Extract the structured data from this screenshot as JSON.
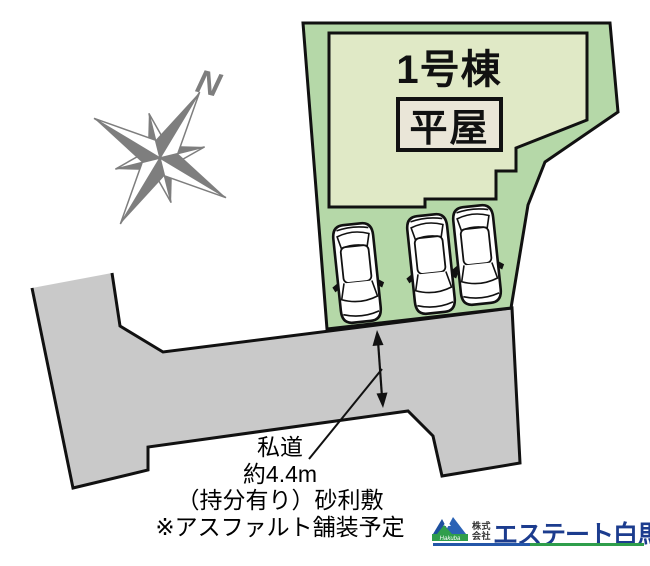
{
  "site_plan": {
    "building_label": "1号棟",
    "building_type_label": "平屋",
    "compass_label": "N",
    "road_note": {
      "line1": "私道",
      "line2": "約4.4m",
      "line3": "（持分有り）砂利敷",
      "line4": "※アスファルト舗装予定"
    },
    "car_count": 3
  },
  "colors": {
    "plot_green": "#b5d8a8",
    "building_fill": "#e0e9c6",
    "type_badge_fill": "#eae6d8",
    "road_gray": "#c9c9c9",
    "outline_black": "#111111",
    "compass_gray": "#7e7e7e"
  },
  "logo": {
    "prefix_line1": "株式",
    "prefix_line2": "会社",
    "company_name": "エステート白馬",
    "mountain_script": "Hakuba",
    "navy": "#1c3c8e",
    "green": "#2f9e4b",
    "blue": "#2456a8"
  }
}
